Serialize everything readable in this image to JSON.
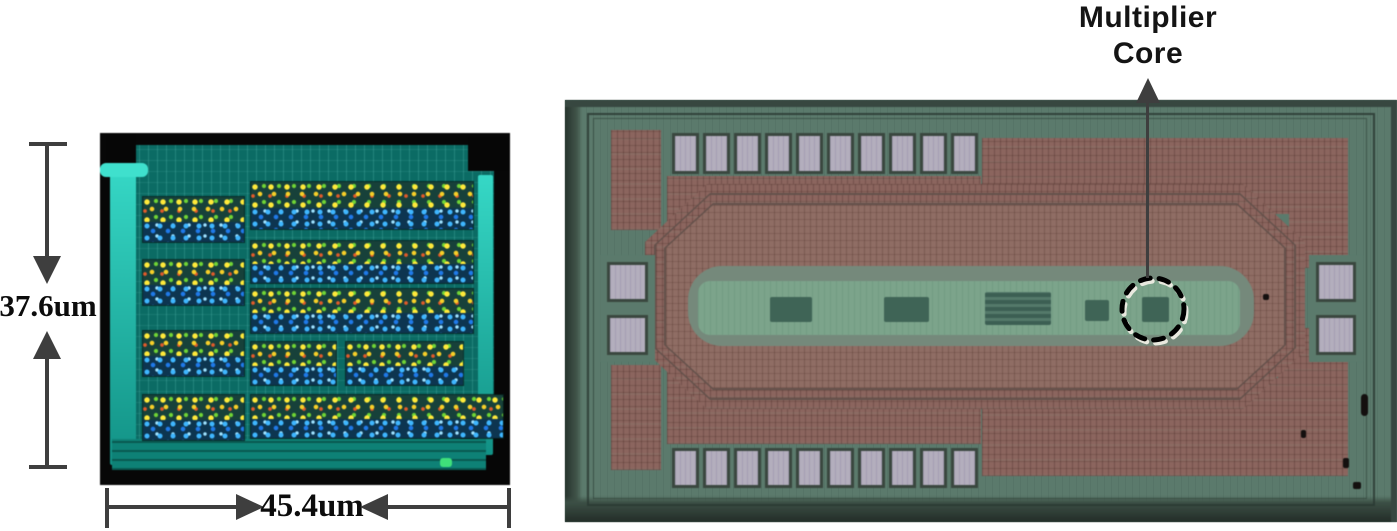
{
  "figure": {
    "left_panel": {
      "title": "multiplier core layout view",
      "height_label": "37.6um",
      "width_label": "45.4um",
      "cell_blocks_left": 4,
      "cell_blocks_right": 6
    },
    "right_panel": {
      "title": "die micrograph",
      "callout": {
        "line1": "Multiplier",
        "line2": "Core"
      },
      "pads": {
        "top": 10,
        "bottom": 10,
        "left": 2,
        "right": 2
      },
      "core_blocks": 5
    },
    "colors": {
      "annotation_gray": "#3e3e3e",
      "layout_teal": "#0b6b64",
      "layout_cyan_bar": "#2cc7b7",
      "cell_yellow": "#ffe93a",
      "cell_blue": "#2a9fe0",
      "die_green": "#5b7a6c",
      "die_fill_red": "#8b655e",
      "pad_gray": "#b3aebd",
      "core_strip_green": "#7ca48b",
      "core_block_green": "#3f6456",
      "marker_black": "#000000",
      "marker_white": "#e9e9df"
    }
  }
}
